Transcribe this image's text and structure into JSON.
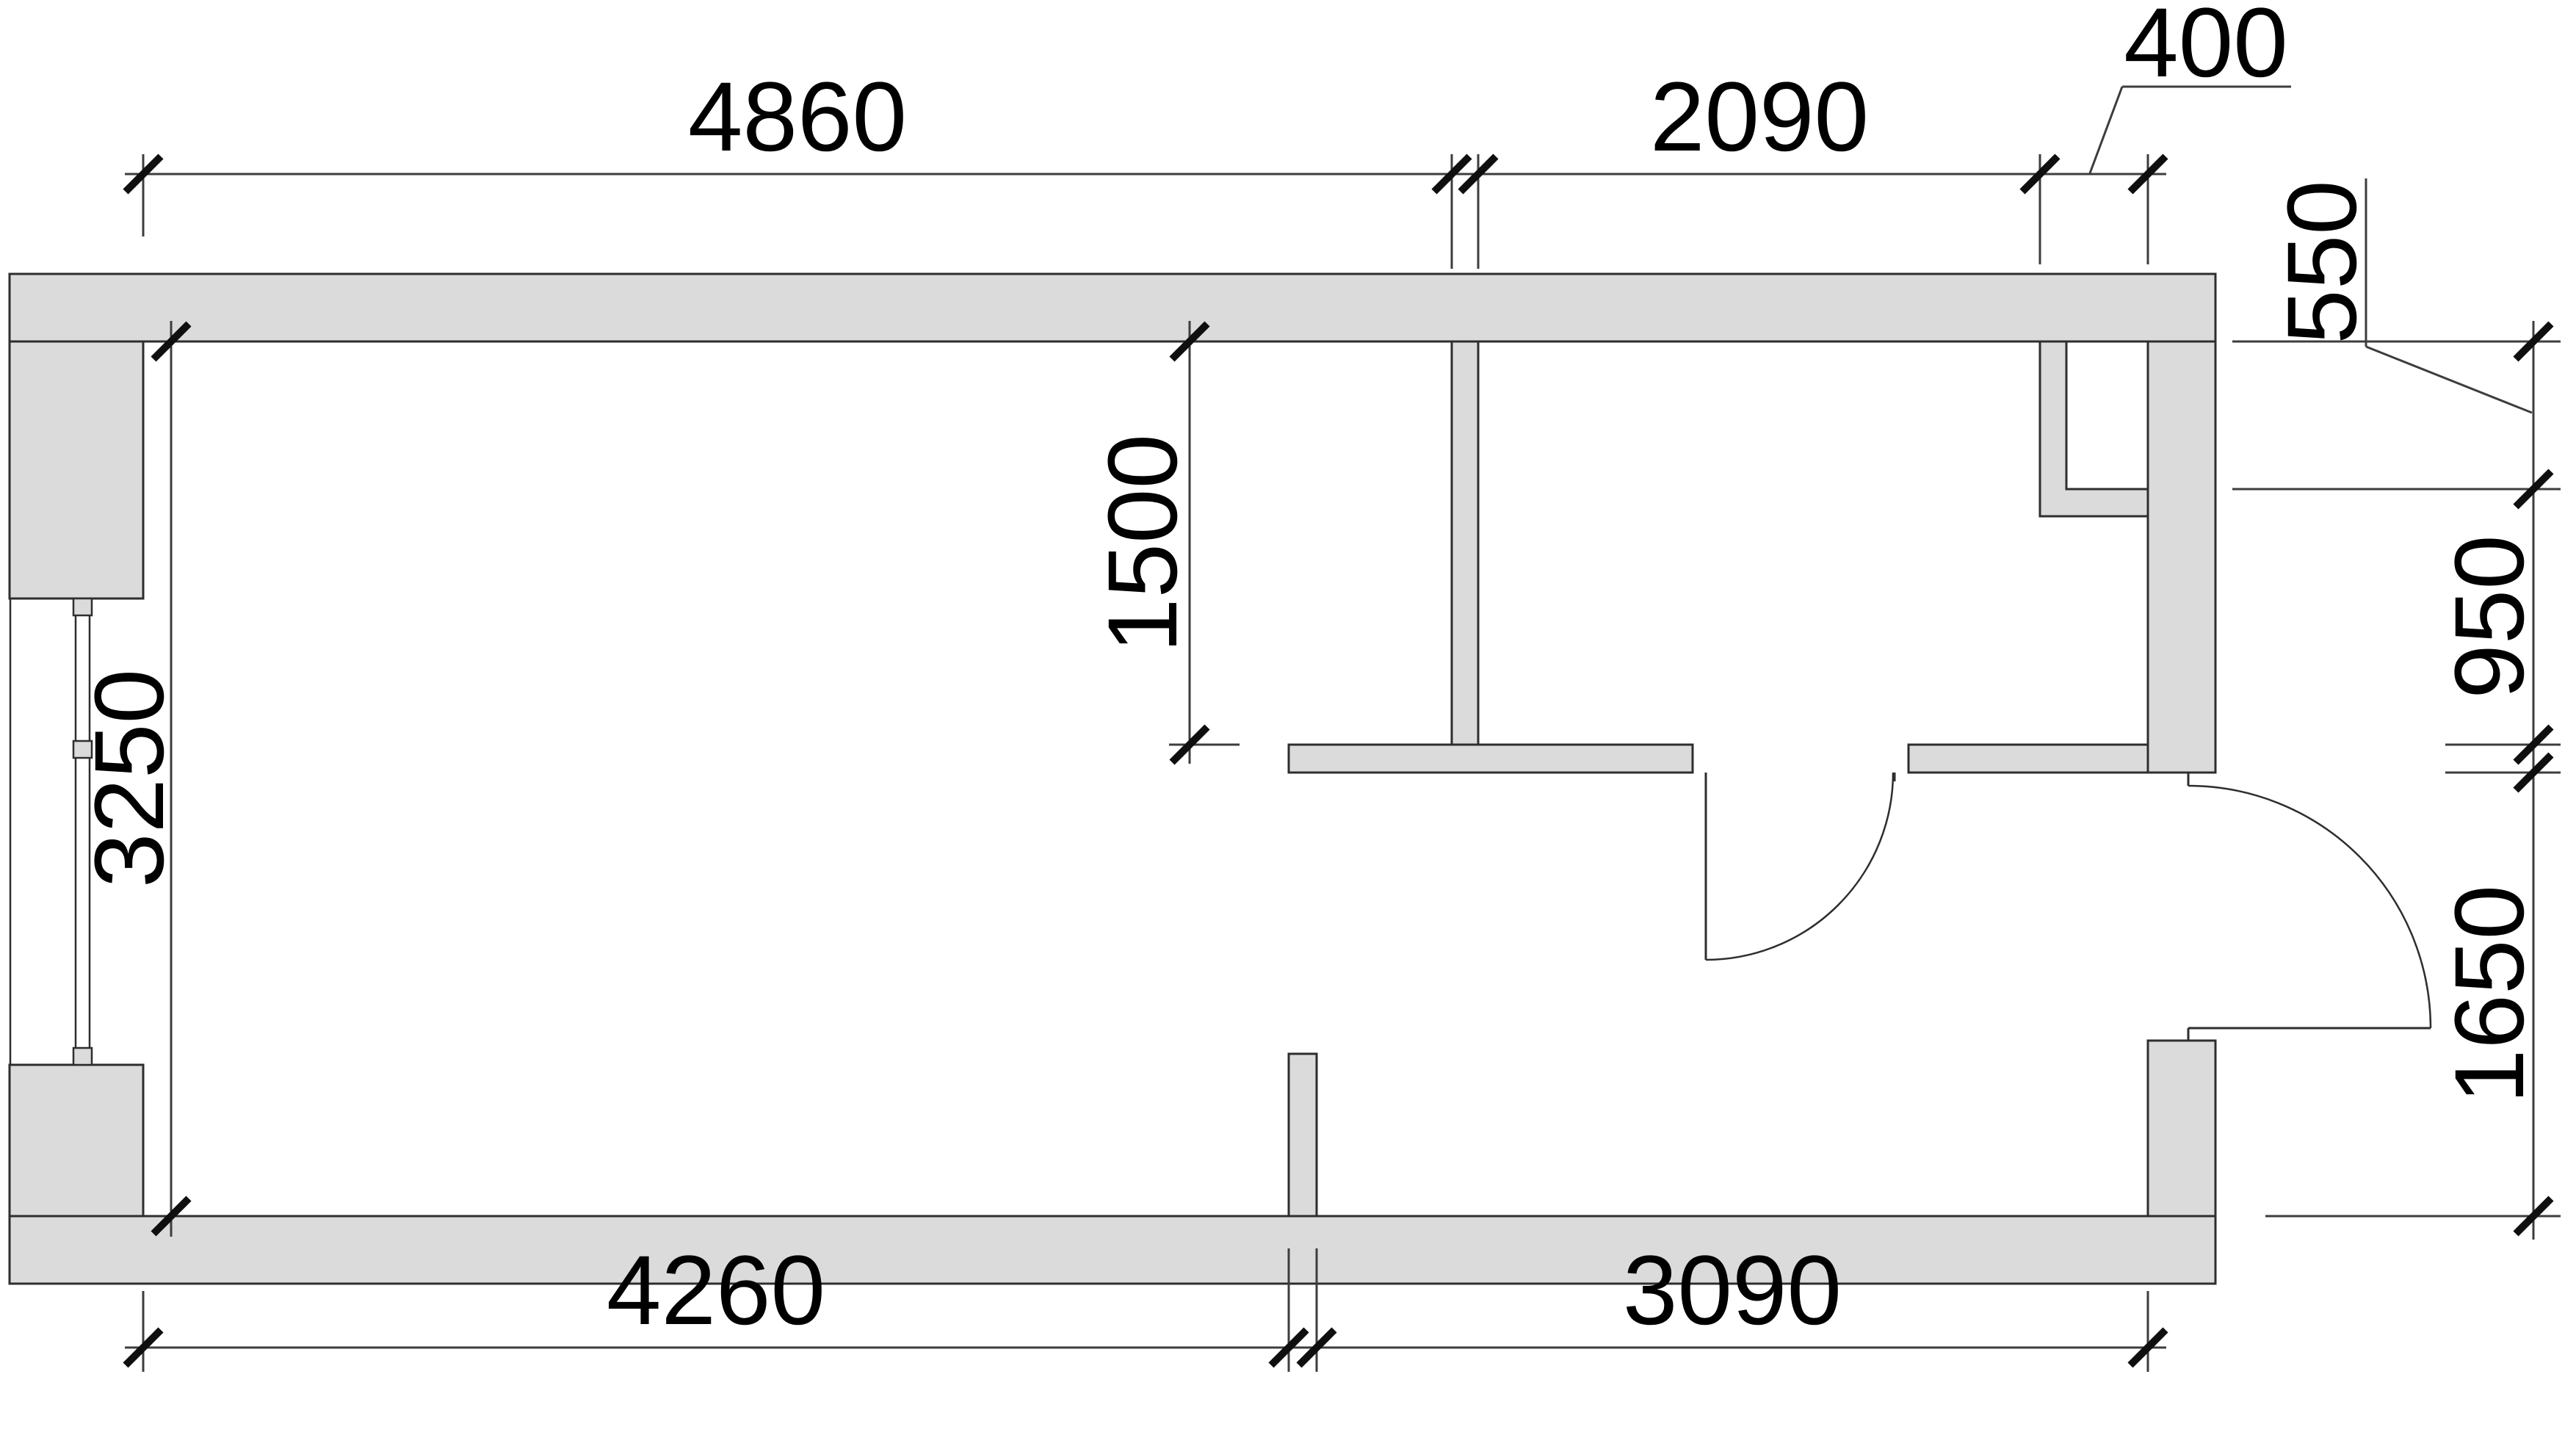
{
  "colors": {
    "background": "#ffffff",
    "wall_fill": "#dbdbdb",
    "wall_line": "#2e2e2e",
    "thin_line": "#2e2e2e",
    "dim_line": "#3d3d3d",
    "tick": "#0f0f0f",
    "text": "#000000"
  },
  "dimensions": {
    "top_chain": {
      "segment_1": "4860",
      "segment_2": "2090",
      "leader": "400"
    },
    "right_chain": {
      "leader": "550",
      "segment_1": "950",
      "segment_2": "1650"
    },
    "bottom_chain": {
      "segment_1": "4260",
      "segment_2": "3090"
    },
    "interior": {
      "room_height": "3250",
      "partition_length": "1500"
    }
  },
  "units": "mm"
}
